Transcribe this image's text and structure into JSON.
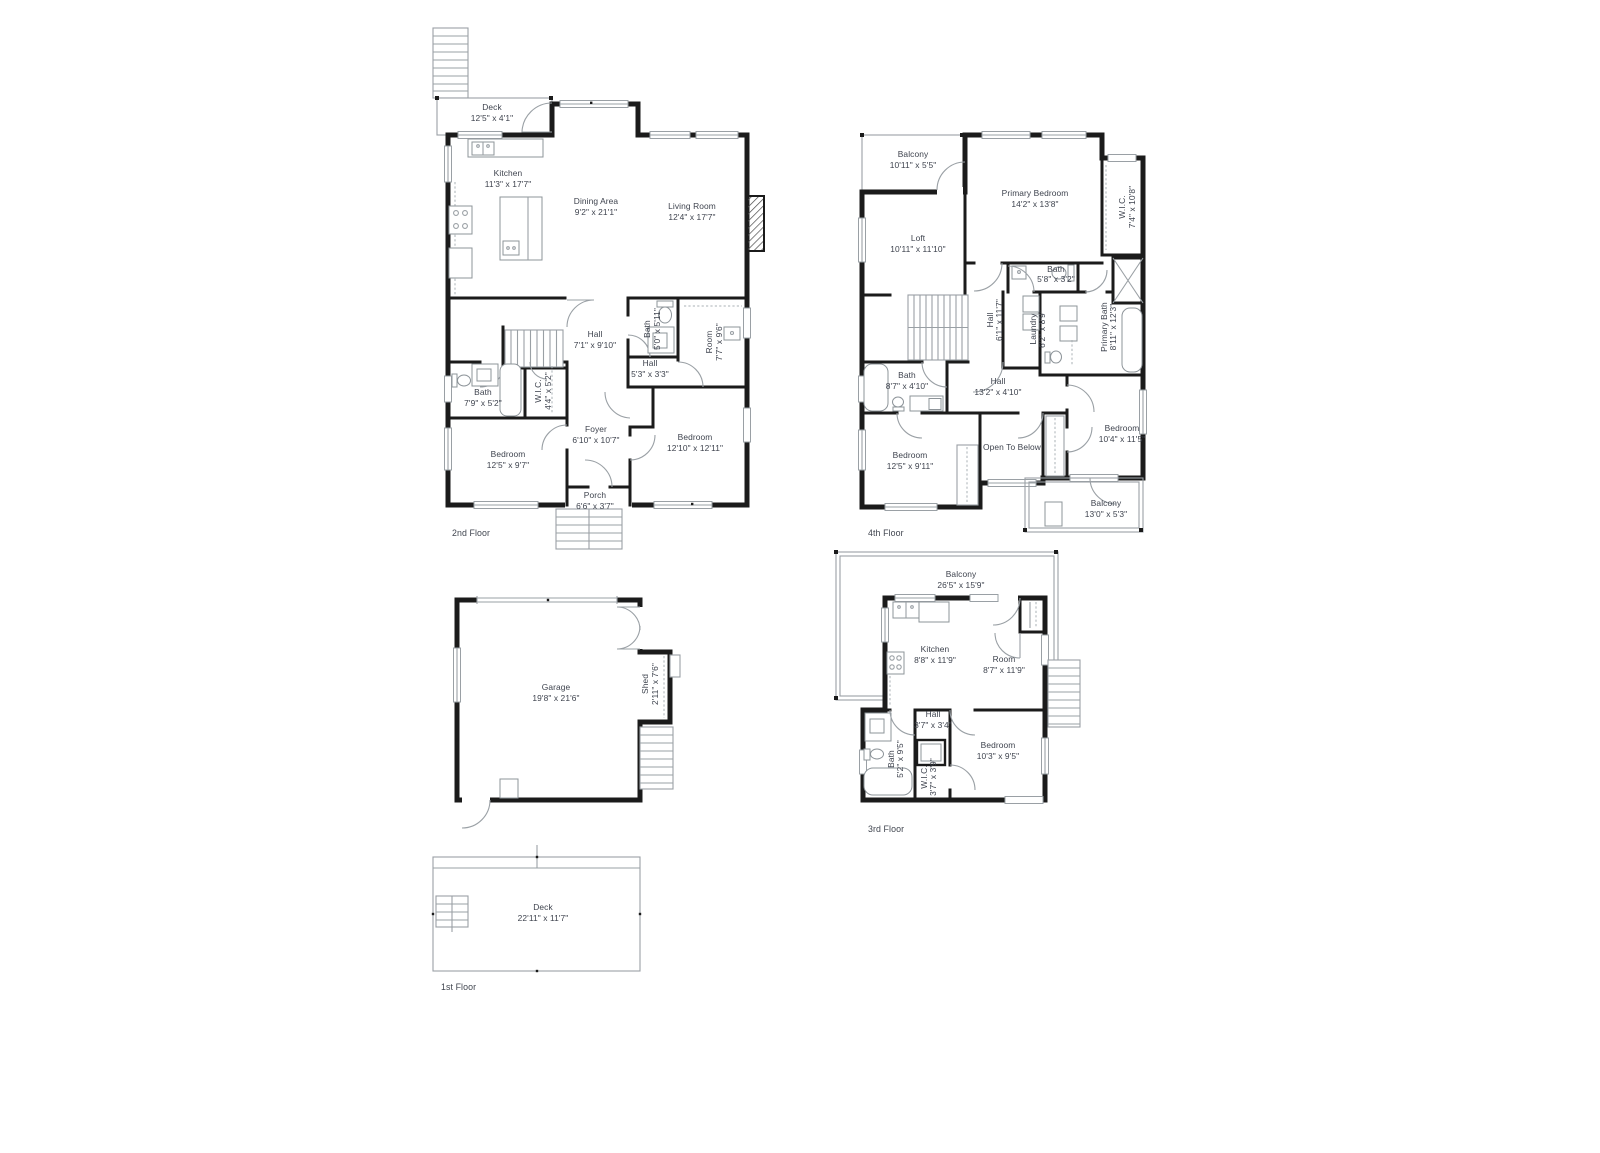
{
  "document": {
    "type": "stacked-floor-plan-sheet",
    "background": "#ffffff"
  },
  "colors": {
    "wall": "#1b1b1b",
    "thin_line": "#9aa0a5",
    "label_text": "#3e434e"
  },
  "floors": {
    "f2": {
      "label": "2nd Floor",
      "rooms": {
        "deck": {
          "name": "Deck",
          "dims": "12'5\" x 4'1\""
        },
        "kitchen": {
          "name": "Kitchen",
          "dims": "11'3\" x 17'7\""
        },
        "dining": {
          "name": "Dining Area",
          "dims": "9'2\" x 21'1\""
        },
        "living": {
          "name": "Living Room",
          "dims": "12'4\" x 17'7\""
        },
        "hall_a": {
          "name": "Hall",
          "dims": "7'1\" x 9'10\""
        },
        "bath_a": {
          "name": "Bath",
          "dims": "5'0\" x 5'11\""
        },
        "room_a": {
          "name": "Room",
          "dims": "7'7\" x 9'6\""
        },
        "hall_b": {
          "name": "Hall",
          "dims": "5'3\" x 3'3\""
        },
        "bath_b": {
          "name": "Bath",
          "dims": "7'9\" x 5'2\""
        },
        "wic": {
          "name": "W.I.C.",
          "dims": "4'4\" x 5'2\""
        },
        "bedroom_a": {
          "name": "Bedroom",
          "dims": "12'5\" x 9'7\""
        },
        "foyer": {
          "name": "Foyer",
          "dims": "6'10\" x 10'7\""
        },
        "bedroom_b": {
          "name": "Bedroom",
          "dims": "12'10\" x 12'11\""
        },
        "porch": {
          "name": "Porch",
          "dims": "6'6\" x 3'7\""
        }
      }
    },
    "f4": {
      "label": "4th Floor",
      "rooms": {
        "balcony_a": {
          "name": "Balcony",
          "dims": "10'11\" x 5'5\""
        },
        "primary_bedroom": {
          "name": "Primary Bedroom",
          "dims": "14'2\" x 13'8\""
        },
        "wic": {
          "name": "W.I.C.",
          "dims": "7'4\" x 10'8\""
        },
        "loft": {
          "name": "Loft",
          "dims": "10'11\" x 11'10\""
        },
        "bath_a": {
          "name": "Bath",
          "dims": "5'8\" x 3'2\""
        },
        "hall_a": {
          "name": "Hall",
          "dims": "6'1\" x 11'7\""
        },
        "laundry": {
          "name": "Laundry",
          "dims": "6'2\" x 8'9\""
        },
        "primary_bath": {
          "name": "Primary Bath",
          "dims": "8'11\" x 12'3\""
        },
        "bath_b": {
          "name": "Bath",
          "dims": "8'7\" x 4'10\""
        },
        "hall_b": {
          "name": "Hall",
          "dims": "13'2\" x 4'10\""
        },
        "bedroom_a": {
          "name": "Bedroom",
          "dims": "12'5\" x 9'11\""
        },
        "open_to_below": {
          "name": "Open To Below"
        },
        "bedroom_b": {
          "name": "Bedroom",
          "dims": "10'4\" x 11'5\""
        },
        "balcony_b": {
          "name": "Balcony",
          "dims": "13'0\" x 5'3\""
        }
      }
    },
    "garage": {
      "rooms": {
        "garage": {
          "name": "Garage",
          "dims": "19'8\" x 21'6\""
        },
        "shed": {
          "name": "Shed",
          "dims": "2'11\" x 7'6\""
        }
      }
    },
    "f3": {
      "label": "3rd Floor",
      "rooms": {
        "balcony": {
          "name": "Balcony",
          "dims": "26'5\" x 15'9\""
        },
        "kitchen": {
          "name": "Kitchen",
          "dims": "8'8\" x 11'9\""
        },
        "room": {
          "name": "Room",
          "dims": "8'7\" x 11'9\""
        },
        "hall": {
          "name": "Hall",
          "dims": "3'7\" x 3'4\""
        },
        "bath": {
          "name": "Bath",
          "dims": "5'2\" x 9'5\""
        },
        "wic": {
          "name": "W.I.C.",
          "dims": "3'7\" x 3'9\""
        },
        "bedroom": {
          "name": "Bedroom",
          "dims": "10'3\" x 9'5\""
        }
      }
    },
    "f1": {
      "label": "1st Floor",
      "rooms": {
        "deck": {
          "name": "Deck",
          "dims": "22'11\" x 11'7\""
        }
      }
    }
  }
}
